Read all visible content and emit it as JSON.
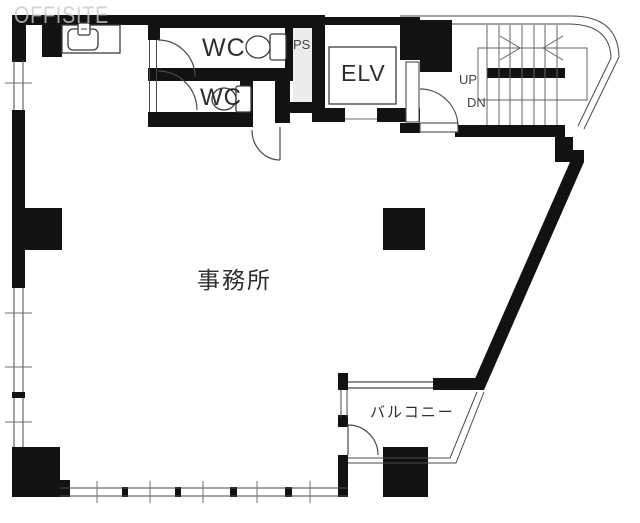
{
  "watermark": {
    "text": "OFFISITE"
  },
  "rooms": {
    "office": {
      "label": "事務所"
    },
    "balcony": {
      "label": "バルコニー"
    },
    "wc_upper": {
      "label": "WC"
    },
    "wc_lower": {
      "label": "WC"
    },
    "pipe_space": {
      "label": "PS"
    },
    "elevator": {
      "label": "ELV"
    },
    "stairs": {
      "up": "UP",
      "down": "DN"
    }
  },
  "icons": {
    "toilet_upper": "toilet-icon",
    "toilet_lower": "toilet-icon",
    "kitchen_sink": "kitchen-sink-icon",
    "stairs": "staircase-icon",
    "doors": "door-swing-arc-icon"
  },
  "colors": {
    "wall": "#121212",
    "line": "#4a4a4a",
    "tick": "#6f6f6f",
    "tread": "#666666",
    "watermark": "#c9c9c9",
    "ps_fill": "#ececec",
    "label": "#2e2e2e",
    "sublabel": "#454545"
  }
}
